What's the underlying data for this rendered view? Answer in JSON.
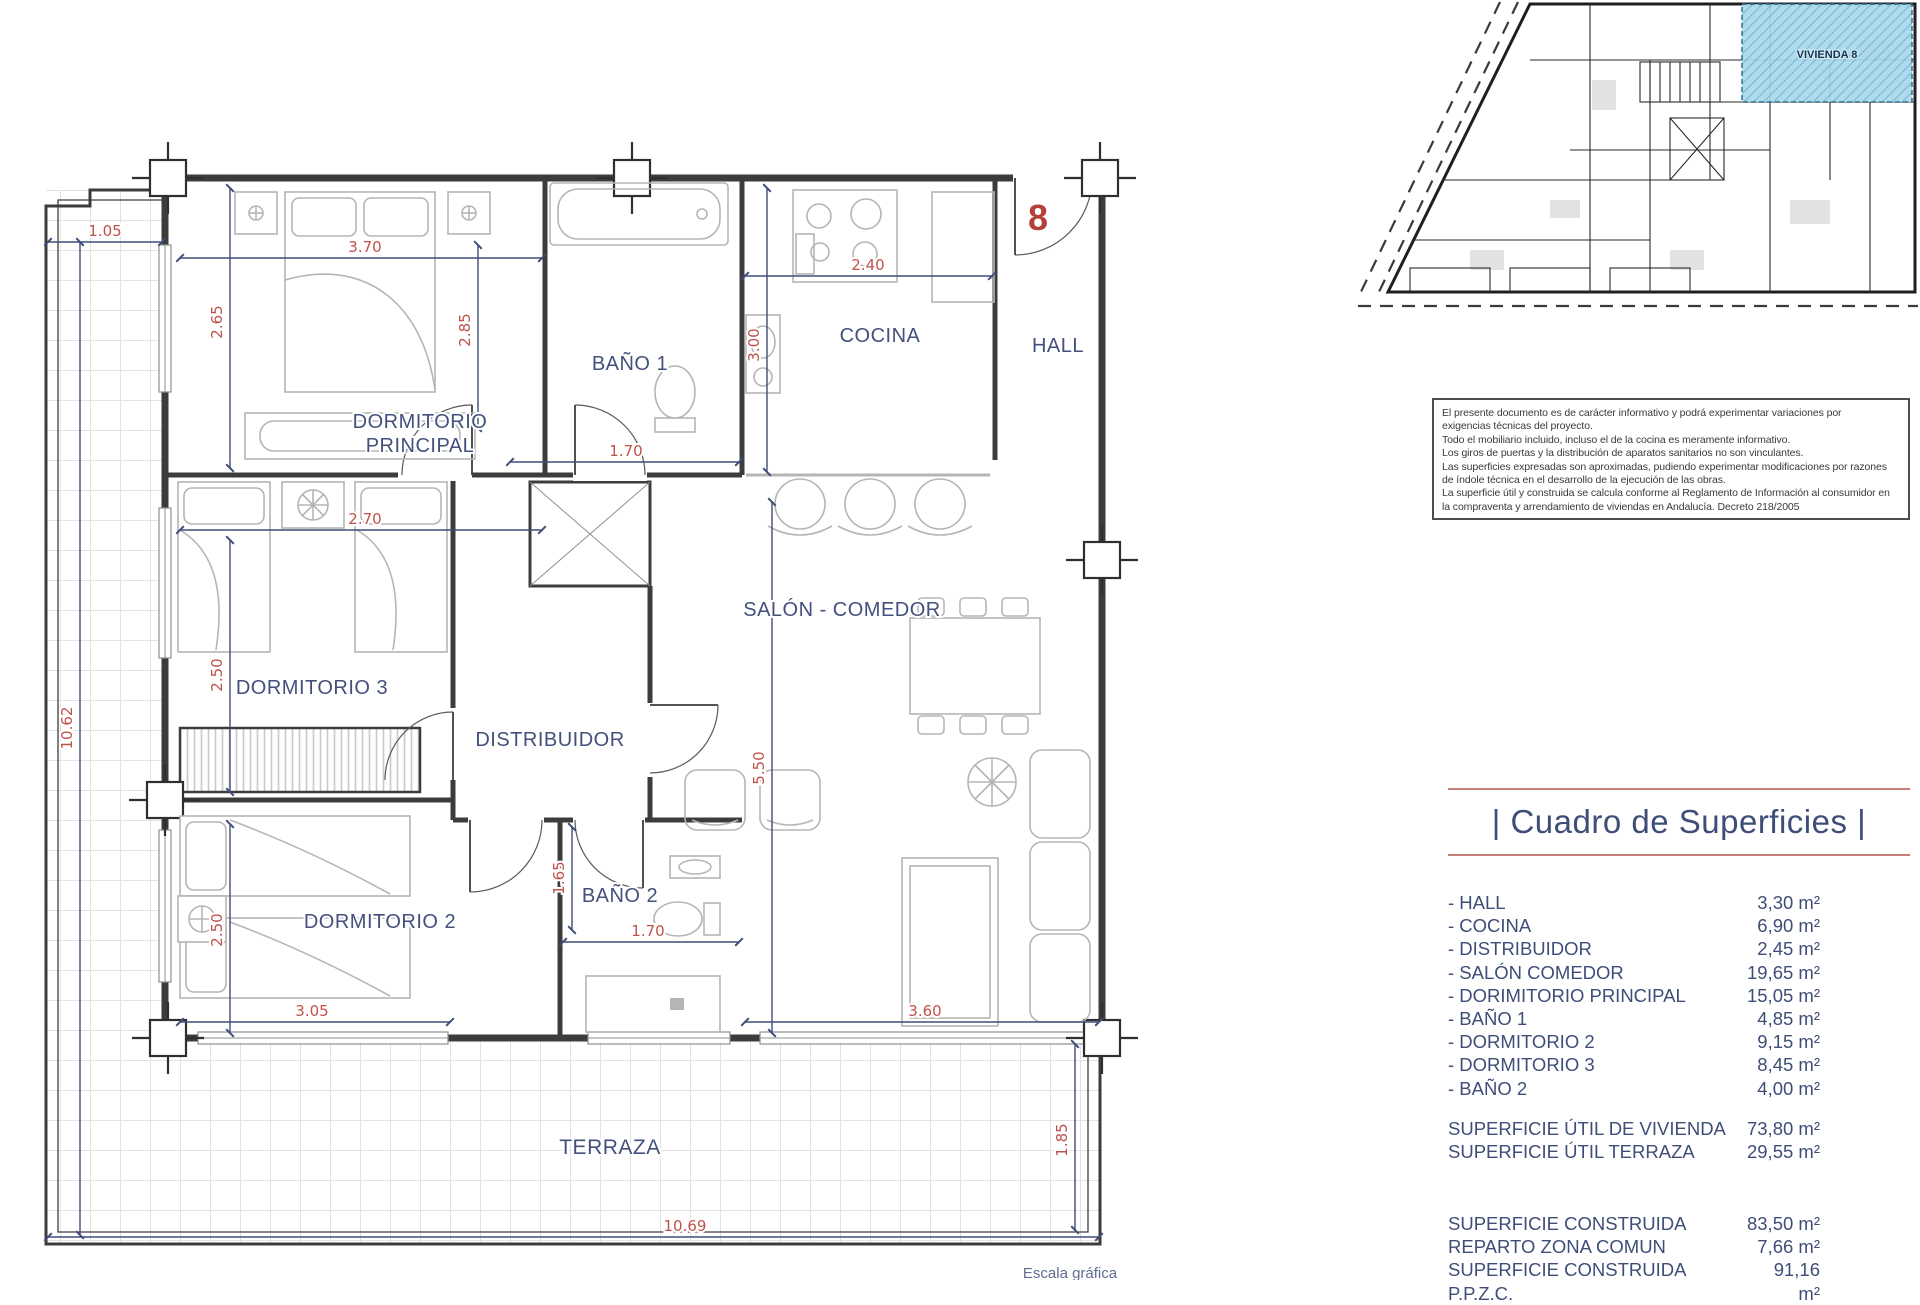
{
  "unit": {
    "number": "8"
  },
  "overview": {
    "highlight_label": "VIVIENDA 8"
  },
  "plan": {
    "labels": {
      "dorm_principal_1": "DORMITORIO",
      "dorm_principal_2": "PRINCIPAL",
      "bano1": "BAÑO 1",
      "cocina": "COCINA",
      "hall": "HALL",
      "salon": "SALÓN - COMEDOR",
      "dorm3": "DORMITORIO 3",
      "distribuidor": "DISTRIBUIDOR",
      "dorm2": "DORMITORIO 2",
      "bano2": "BAÑO 2",
      "terraza": "TERRAZA",
      "escala": "Escala gráfica"
    },
    "dims": {
      "terraza_top": "1.05",
      "dp_w": "3.70",
      "dp_h": "2.65",
      "b1_h": "2.85",
      "b1_w": "1.70",
      "cocina_w": "2.40",
      "cocina_h": "3.00",
      "salon_h": "5.50",
      "d3_w": "2.70",
      "d3_h": "2.50",
      "total_h": "10.62",
      "d2_h": "2.50",
      "b2_pass": "1.65",
      "b2_w": "1.70",
      "d2_w": "3.05",
      "salon_w": "3.60",
      "terraza_b_h": "1.85",
      "terraza_b_w": "10.69"
    }
  },
  "disclaimer": {
    "lines": [
      "El presente documento es de carácter informativo y podrá experimentar variaciones por",
      "exigencias técnicas del proyecto.",
      "Todo el mobiliario incluido, incluso el de la cocina es meramente informativo.",
      "Los giros de puertas y la distribución de aparatos sanitarios no son vinculantes.",
      "Las superficies expresadas son aproximadas, pudiendo experimentar modificaciones por razones",
      "de índole técnica en el desarrollo de la ejecución de las obras.",
      "La superficie útil y construida se calcula conforme al Reglamento de Información al consumidor en",
      "la compraventa y arrendamiento de viviendas en Andalucía. Decreto 218/2005"
    ]
  },
  "surfaces": {
    "title": "| Cuadro de Superficies |",
    "rooms": [
      {
        "label": "- HALL",
        "value": "3,30 m²"
      },
      {
        "label": "- COCINA",
        "value": "6,90 m²"
      },
      {
        "label": "- DISTRIBUIDOR",
        "value": "2,45 m²"
      },
      {
        "label": "- SALÓN COMEDOR",
        "value": "19,65 m²"
      },
      {
        "label": "- DORIMITORIO PRINCIPAL",
        "value": "15,05 m²"
      },
      {
        "label": "- BAÑO 1",
        "value": "4,85 m²"
      },
      {
        "label": "- DORMITORIO 2",
        "value": "9,15 m²"
      },
      {
        "label": "- DORMITORIO 3",
        "value": "8,45 m²"
      },
      {
        "label": "- BAÑO 2",
        "value": "4,00 m²"
      }
    ],
    "useful": [
      {
        "label": "SUPERFICIE ÚTIL DE VIVIENDA",
        "value": "73,80 m²"
      },
      {
        "label": "SUPERFICIE ÚTIL TERRAZA",
        "value": "29,55 m²"
      }
    ],
    "built": [
      {
        "label": "SUPERFICIE CONSTRUIDA",
        "value": "83,50 m²"
      },
      {
        "label": "REPARTO ZONA COMUN",
        "value": "7,66 m²"
      },
      {
        "label": "SUPERFICIE CONSTRUIDA P.P.Z.C.",
        "value": "91,16 m²"
      }
    ]
  }
}
